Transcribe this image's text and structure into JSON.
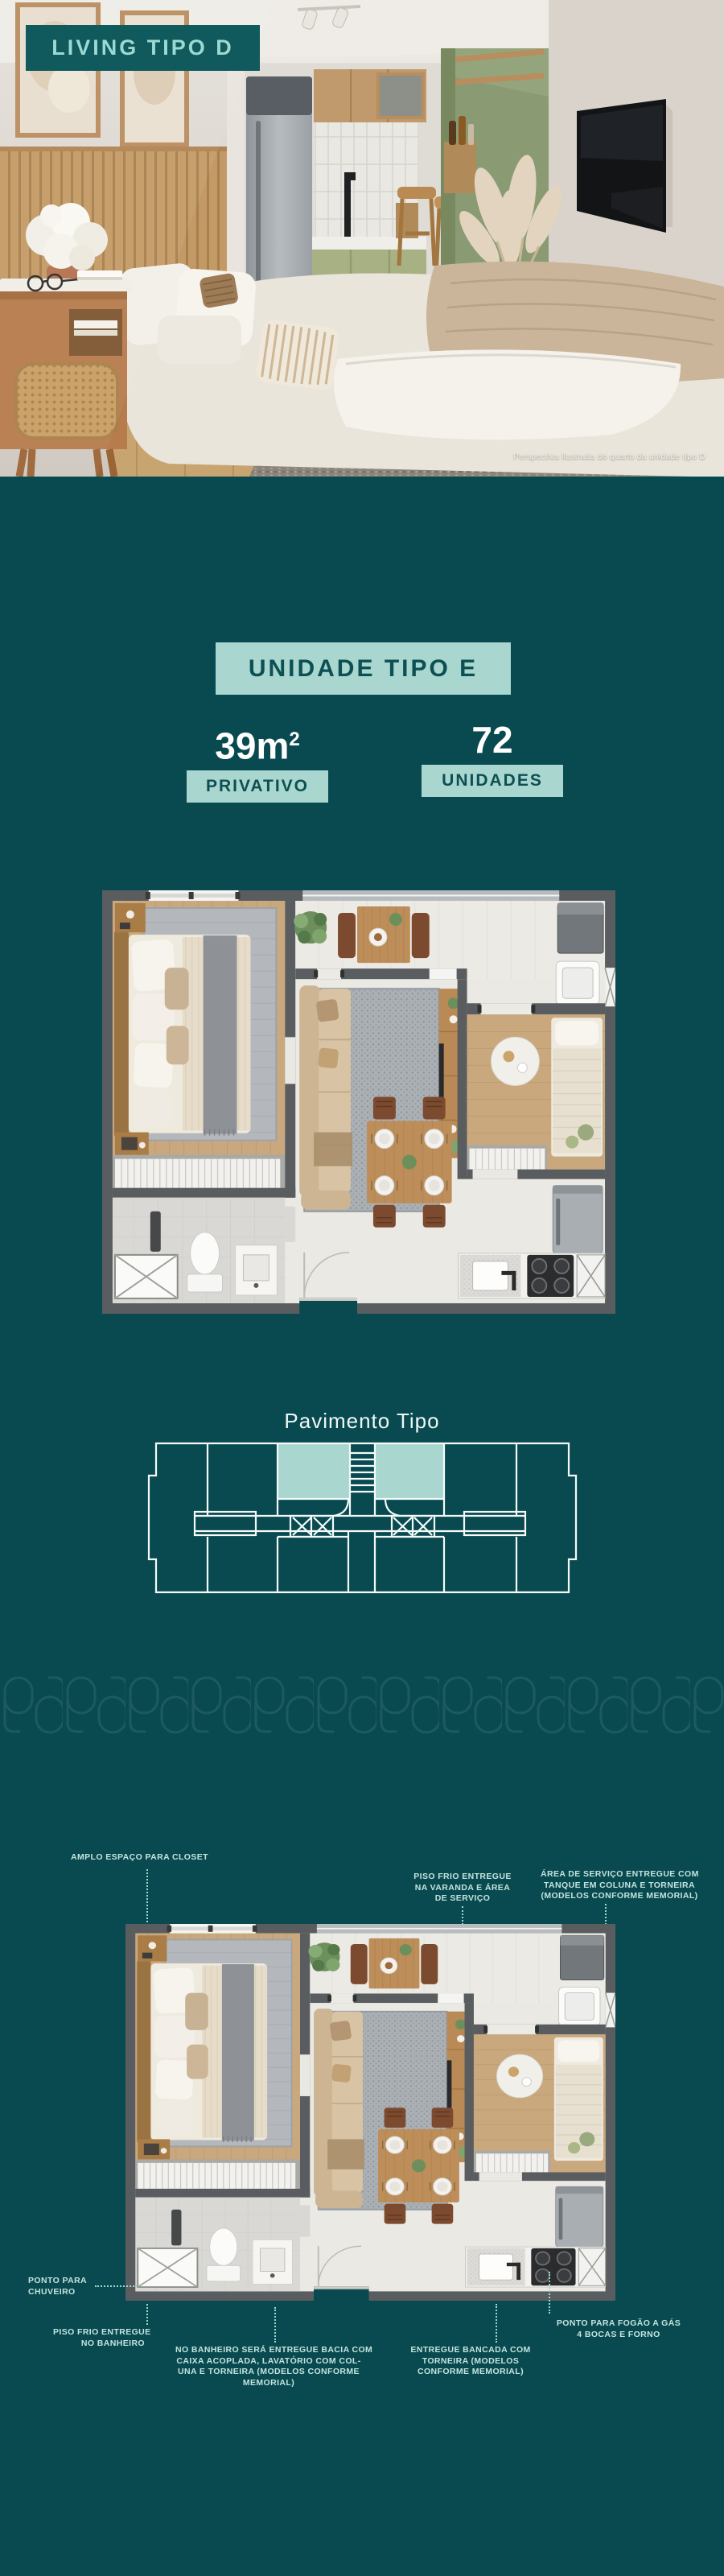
{
  "colors": {
    "background_teal": "#094A50",
    "label_box_teal": "#10595D",
    "mint_accent": "#A9D6CF",
    "mint_text": "#9CD9D1",
    "dark_teal_text": "#0C5054",
    "annotation_text": "#C2E4DF",
    "white": "#FFFFFF"
  },
  "hero": {
    "label": "LIVING TIPO D",
    "caption": "Perspectiva ilustrada do quarto da unidade tipo D"
  },
  "unit": {
    "title": "UNIDADE TIPO E",
    "area": {
      "value": "39m",
      "sup": "2",
      "label": "PRIVATIVO"
    },
    "count": {
      "value": "72",
      "label": "UNIDADES"
    }
  },
  "pavimento": {
    "title": "Pavimento Tipo"
  },
  "plan_annotations": {
    "closet": {
      "lines": [
        "AMPLO ESPAÇO PARA CLOSET"
      ]
    },
    "varanda": {
      "lines": [
        "PISO FRIO ENTREGUE",
        "NA VARANDA E ÁREA",
        "DE SERVIÇO"
      ]
    },
    "servico": {
      "lines": [
        "ÁREA DE SERVIÇO ENTREGUE COM",
        "TANQUE EM COLUNA E TORNEIRA",
        "(MODELOS CONFORME MEMORIAL)"
      ]
    },
    "chuveiro": {
      "lines": [
        "PONTO PARA",
        "CHUVEIRO"
      ]
    },
    "piso_banheiro": {
      "lines": [
        "PISO FRIO ENTREGUE",
        "NO BANHEIRO"
      ]
    },
    "bacia": {
      "lines": [
        "NO BANHEIRO SERÁ ENTREGUE BACIA COM",
        "CAIXA ACOPLADA, LAVATÓRIO COM COL-",
        "UNA E TORNEIRA (MODELOS CONFORME",
        "MEMORIAL)"
      ]
    },
    "bancada": {
      "lines": [
        "ENTREGUE BANCADA COM",
        "TORNEIRA (MODELOS",
        "CONFORME MEMORIAL)"
      ]
    },
    "fogao": {
      "lines": [
        "PONTO PARA FOGÃO A  GÁS",
        "4 BOCAS E FORNO"
      ]
    }
  }
}
